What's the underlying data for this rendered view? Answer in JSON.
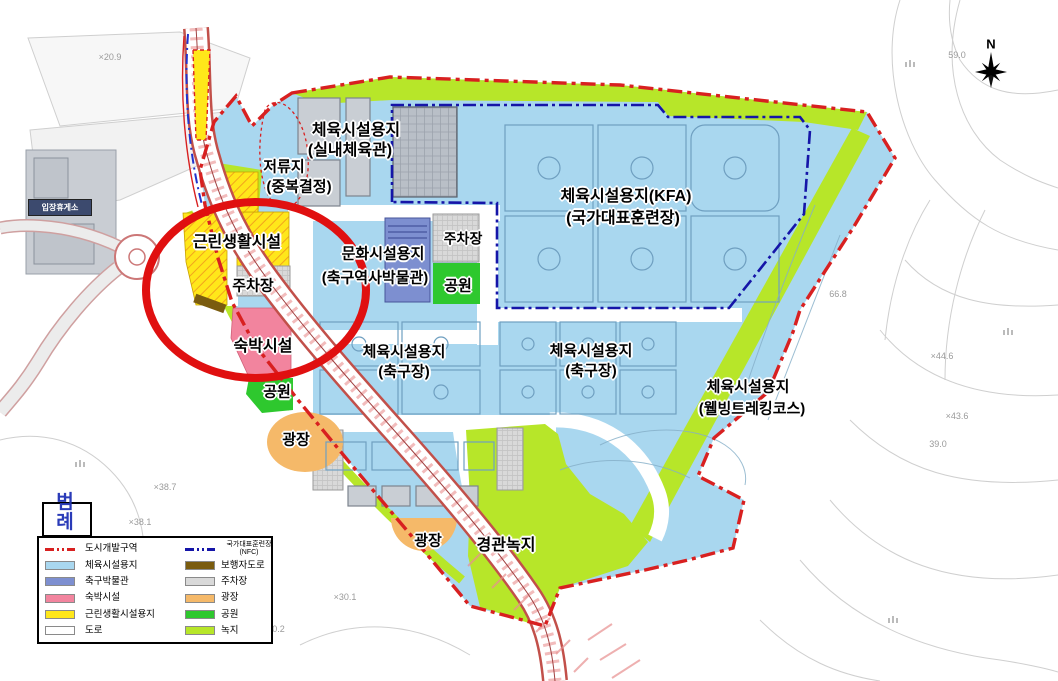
{
  "map": {
    "labels": {
      "indoor_gym_1": "체육시설용지",
      "indoor_gym_2": "(실내체육관)",
      "retention_1": "저류지",
      "retention_2": "(중복결정)",
      "kfa_1": "체육시설용지(KFA)",
      "kfa_2": "(국가대표훈련장)",
      "neighborhood": "근린생활시설",
      "parking_left": "주차장",
      "parking_top": "주차장",
      "culture_1": "문화시설용지",
      "culture_2": "(축구역사박물관)",
      "park_right": "공원",
      "park_left": "공원",
      "lodging": "숙박시설",
      "soccer_left_1": "체육시설용지",
      "soccer_left_2": "(축구장)",
      "soccer_right_1": "체육시설용지",
      "soccer_right_2": "(축구장)",
      "wellbeing_1": "체육시설용지",
      "wellbeing_2": "(웰빙트레킹코스)",
      "plaza_left": "광장",
      "plaza_bottom": "광장",
      "landscape_green": "경관녹지",
      "rest_area": "입장휴게소",
      "compass_n": "N"
    },
    "elevations": {
      "e1": "×20.9",
      "e2": "59.0",
      "e3": "66.8",
      "e4": "×44.6",
      "e5": "×43.6",
      "e6": "39.0",
      "e7": "×38.7",
      "e8": "×38.1",
      "e9": "×30.1",
      "e10": "30.2"
    }
  },
  "legend": {
    "title": "범례",
    "left": [
      {
        "label": "도시개발구역"
      },
      {
        "label": "체육시설용지"
      },
      {
        "label": "축구박물관"
      },
      {
        "label": "숙박시설"
      },
      {
        "label": "근린생활시설용지"
      },
      {
        "label": "도로"
      }
    ],
    "right": [
      {
        "label": "보행자도로"
      },
      {
        "label": "주차장"
      },
      {
        "label": "광장"
      },
      {
        "label": "공원"
      },
      {
        "label": "녹지"
      }
    ],
    "nfc_line1": "국가대표훈련장",
    "nfc_line2": "(NFC)"
  },
  "colors": {
    "city_dev_zone_line": "#d82020",
    "nfc_line": "#1515a8",
    "sports_site": "#a9d7ef",
    "soccer_museum": "#7d8fd0",
    "lodging": "#f2849e",
    "neighborhood_site": "#ffe71a",
    "road": "#ffffff",
    "pedestrian_road": "#7a5c0f",
    "parking": "#d9d9d9",
    "plaza": "#f5b969",
    "park": "#2ec82e",
    "green_space": "#b7e629",
    "annotation_circle": "#e01010"
  }
}
